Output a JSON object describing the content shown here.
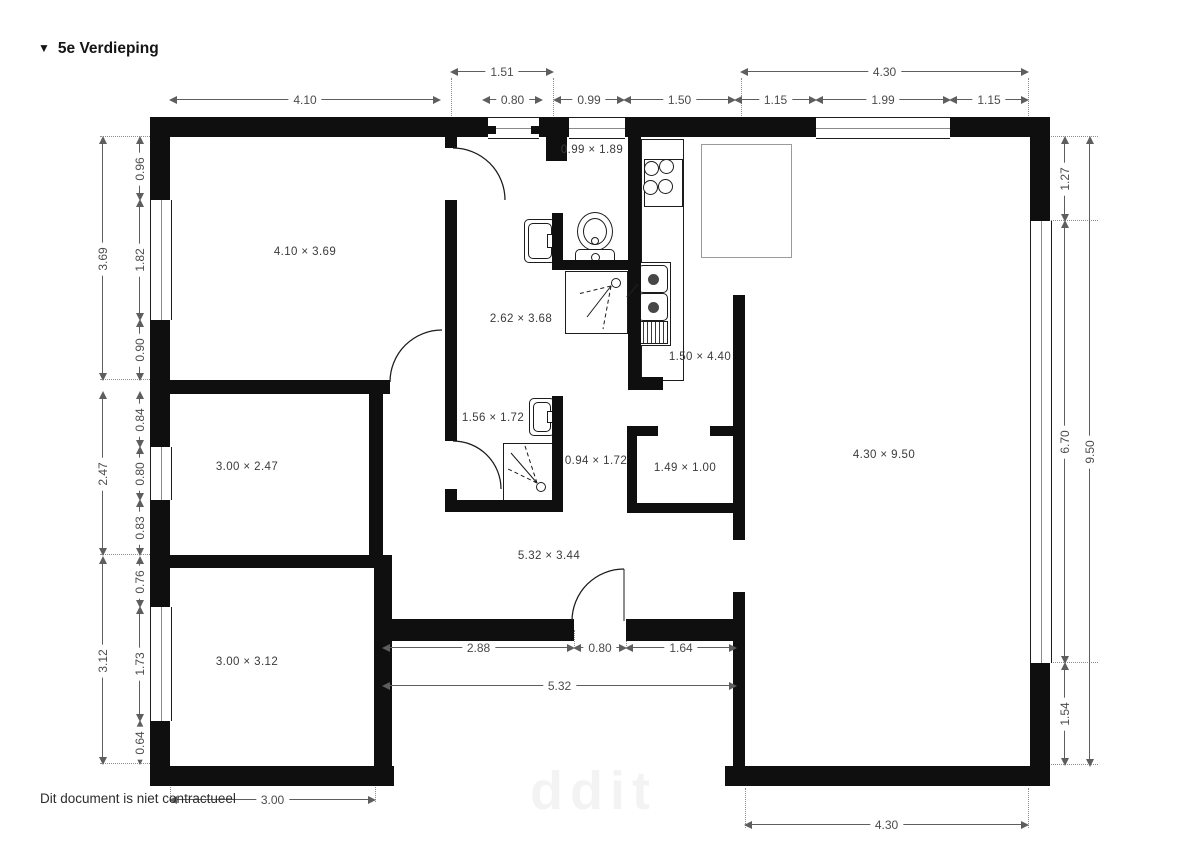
{
  "title": {
    "marker": "▼",
    "text": "5e Verdieping"
  },
  "footer": {
    "text": "Dit document is niet contractueel"
  },
  "watermark": {
    "text": "ddit"
  },
  "colors": {
    "wall": "#0f0f0f",
    "dimension_line": "#5e5e5e",
    "label": "#3b3b3b"
  },
  "plan": {
    "rooms": [
      {
        "x": 305,
        "y": 252,
        "t": "4.10 × 3.69"
      },
      {
        "x": 521,
        "y": 319,
        "t": "2.62 × 3.68"
      },
      {
        "x": 592,
        "y": 150,
        "t": "0.99 × 1.89"
      },
      {
        "x": 700,
        "y": 357,
        "t": "1.50 × 4.40"
      },
      {
        "x": 247,
        "y": 467,
        "t": "3.00 × 2.47"
      },
      {
        "x": 493,
        "y": 418,
        "t": "1.56 × 1.72"
      },
      {
        "x": 596,
        "y": 461,
        "t": "0.94 × 1.72"
      },
      {
        "x": 685,
        "y": 468,
        "t": "1.49 × 1.00"
      },
      {
        "x": 884,
        "y": 455,
        "t": "4.30 × 9.50"
      },
      {
        "x": 247,
        "y": 662,
        "t": "3.00 × 3.12"
      },
      {
        "x": 549,
        "y": 556,
        "t": "5.32 × 3.44"
      }
    ],
    "dims_h": [
      {
        "x": 451,
        "y": 66,
        "w": 102,
        "t": "1.51"
      },
      {
        "x": 741,
        "y": 66,
        "w": 287,
        "t": "4.30"
      },
      {
        "x": 170,
        "y": 94,
        "w": 270,
        "t": "4.10"
      },
      {
        "x": 483,
        "y": 94,
        "w": 59,
        "t": "0.80"
      },
      {
        "x": 554,
        "y": 94,
        "w": 70,
        "t": "0.99"
      },
      {
        "x": 624,
        "y": 94,
        "w": 111,
        "t": "1.50"
      },
      {
        "x": 735,
        "y": 94,
        "w": 81,
        "t": "1.15"
      },
      {
        "x": 816,
        "y": 94,
        "w": 134,
        "t": "1.99"
      },
      {
        "x": 950,
        "y": 94,
        "w": 78,
        "t": "1.15"
      },
      {
        "x": 383,
        "y": 642,
        "w": 191,
        "t": "2.88"
      },
      {
        "x": 574,
        "y": 642,
        "w": 52,
        "t": "0.80"
      },
      {
        "x": 626,
        "y": 642,
        "w": 110,
        "t": "1.64"
      },
      {
        "x": 383,
        "y": 680,
        "w": 353,
        "t": "5.32"
      },
      {
        "x": 170,
        "y": 794,
        "w": 205,
        "t": "3.00"
      },
      {
        "x": 745,
        "y": 819,
        "w": 283,
        "t": "4.30"
      }
    ],
    "dims_v": [
      {
        "x": 97,
        "y": 137,
        "h": 243,
        "t": "3.69"
      },
      {
        "x": 134,
        "y": 137,
        "h": 63,
        "t": "0.96"
      },
      {
        "x": 134,
        "y": 200,
        "h": 120,
        "t": "1.82"
      },
      {
        "x": 134,
        "y": 320,
        "h": 60,
        "t": "0.90"
      },
      {
        "x": 97,
        "y": 392,
        "h": 163,
        "t": "2.47"
      },
      {
        "x": 134,
        "y": 392,
        "h": 55,
        "t": "0.84"
      },
      {
        "x": 134,
        "y": 447,
        "h": 53,
        "t": "0.80"
      },
      {
        "x": 134,
        "y": 500,
        "h": 55,
        "t": "0.83"
      },
      {
        "x": 97,
        "y": 557,
        "h": 207,
        "t": "3.12"
      },
      {
        "x": 134,
        "y": 557,
        "h": 50,
        "t": "0.76"
      },
      {
        "x": 134,
        "y": 607,
        "h": 114,
        "t": "1.73"
      },
      {
        "x": 134,
        "y": 721,
        "h": 43,
        "t": "0.64"
      },
      {
        "x": 1059,
        "y": 137,
        "h": 84,
        "t": "1.27"
      },
      {
        "x": 1059,
        "y": 221,
        "h": 442,
        "t": "6.70"
      },
      {
        "x": 1059,
        "y": 663,
        "h": 102,
        "t": "1.54"
      },
      {
        "x": 1084,
        "y": 137,
        "h": 629,
        "t": "9.50"
      }
    ],
    "walls": [
      [
        150,
        117,
        338,
        20
      ],
      [
        539,
        117,
        30,
        20
      ],
      [
        625,
        117,
        191,
        20
      ],
      [
        950,
        117,
        100,
        20
      ],
      [
        150,
        117,
        20,
        83
      ],
      [
        150,
        320,
        20,
        127
      ],
      [
        150,
        500,
        20,
        107
      ],
      [
        150,
        721,
        20,
        65
      ],
      [
        1030,
        117,
        20,
        104
      ],
      [
        1030,
        663,
        20,
        123
      ],
      [
        150,
        766,
        244,
        20
      ],
      [
        725,
        766,
        325,
        20
      ],
      [
        170,
        380,
        220,
        14
      ],
      [
        445,
        134,
        12,
        14
      ],
      [
        445,
        200,
        12,
        194
      ],
      [
        445,
        394,
        12,
        47
      ],
      [
        445,
        489,
        12,
        23
      ],
      [
        445,
        500,
        118,
        12
      ],
      [
        552,
        396,
        11,
        104
      ],
      [
        546,
        134,
        21,
        27
      ],
      [
        552,
        213,
        11,
        51
      ],
      [
        552,
        260,
        76,
        10
      ],
      [
        628,
        137,
        13,
        253
      ],
      [
        628,
        377,
        35,
        13
      ],
      [
        627,
        426,
        31,
        10
      ],
      [
        710,
        426,
        25,
        10
      ],
      [
        627,
        426,
        10,
        87
      ],
      [
        627,
        503,
        108,
        10
      ],
      [
        369,
        394,
        14,
        161
      ],
      [
        170,
        555,
        204,
        13
      ],
      [
        374,
        555,
        18,
        231
      ],
      [
        374,
        619,
        200,
        22
      ],
      [
        626,
        619,
        119,
        22
      ],
      [
        733,
        295,
        12,
        245
      ],
      [
        733,
        592,
        12,
        174
      ]
    ],
    "windows_h": [
      [
        488,
        117,
        51,
        20
      ],
      [
        569,
        117,
        56,
        20
      ],
      [
        816,
        117,
        134,
        20
      ]
    ],
    "windows_v": [
      [
        150,
        200,
        20,
        120
      ],
      [
        150,
        447,
        20,
        53
      ],
      [
        150,
        607,
        20,
        114
      ],
      [
        1030,
        221,
        20,
        442
      ]
    ],
    "jambs": [
      [
        488,
        126,
        8,
        8
      ],
      [
        531,
        126,
        8,
        8
      ]
    ],
    "ext_v": [
      [
        451,
        78,
        56
      ],
      [
        553,
        78,
        42
      ],
      [
        741,
        78,
        40
      ],
      [
        1028,
        78,
        40
      ],
      [
        170,
        770,
        32
      ],
      [
        375,
        642,
        160
      ],
      [
        745,
        788,
        40
      ],
      [
        1028,
        788,
        40
      ],
      [
        574,
        630,
        16
      ],
      [
        626,
        630,
        16
      ]
    ],
    "ext_h": [
      [
        100,
        136,
        52
      ],
      [
        100,
        379,
        52
      ],
      [
        100,
        554,
        52
      ],
      [
        100,
        763,
        52
      ],
      [
        1048,
        136,
        50
      ],
      [
        1048,
        220,
        50
      ],
      [
        1048,
        662,
        50
      ],
      [
        1048,
        764,
        50
      ]
    ],
    "fixtures": [
      {
        "k": "r",
        "n": "kitchen-counter",
        "x": 641,
        "y": 139,
        "w": 41,
        "h": 240
      },
      {
        "k": "r",
        "n": "stove-icon",
        "x": 644,
        "y": 159,
        "w": 37,
        "h": 46
      },
      {
        "k": "c",
        "n": "stove-burner-icon",
        "x": 650,
        "y": 167,
        "d": 13
      },
      {
        "k": "c",
        "n": "stove-burner-icon",
        "x": 665,
        "y": 165,
        "d": 13
      },
      {
        "k": "c",
        "n": "stove-burner-icon",
        "x": 649,
        "y": 186,
        "d": 13
      },
      {
        "k": "c",
        "n": "stove-burner-icon",
        "x": 664,
        "y": 185,
        "d": 13
      },
      {
        "k": "r",
        "n": "kitchen-sink-icon",
        "x": 635,
        "y": 262,
        "w": 34,
        "h": 82
      },
      {
        "k": "r",
        "n": "sink-basin",
        "x": 638,
        "y": 265,
        "w": 28,
        "h": 26,
        "rd": 1
      },
      {
        "k": "r",
        "n": "sink-basin",
        "x": 638,
        "y": 293,
        "w": 28,
        "h": 26,
        "rd": 1
      },
      {
        "k": "c",
        "n": "sink-drain",
        "x": 652,
        "y": 278,
        "d": 9,
        "f": 1
      },
      {
        "k": "c",
        "n": "sink-drain",
        "x": 652,
        "y": 306,
        "d": 9,
        "f": 1
      },
      {
        "k": "h",
        "n": "sink-drainer",
        "x": 638,
        "y": 321,
        "w": 28,
        "h": 21
      },
      {
        "k": "r",
        "n": "island-counter",
        "x": 701,
        "y": 144,
        "w": 89,
        "h": 112,
        "gy": 1
      },
      {
        "k": "r",
        "n": "toilet-icon",
        "x": 577,
        "y": 212,
        "w": 34,
        "h": 37,
        "ell": 1
      },
      {
        "k": "r",
        "n": "toilet-bowl-inner",
        "x": 583,
        "y": 218,
        "w": 22,
        "h": 25,
        "ell": 1
      },
      {
        "k": "c",
        "n": "toilet-flush-dot",
        "x": 594,
        "y": 240,
        "d": 6
      },
      {
        "k": "r",
        "n": "toilet-cistern",
        "x": 575,
        "y": 249,
        "w": 38,
        "h": 15,
        "rd": 1
      },
      {
        "k": "c",
        "n": "toilet-flush-dot",
        "x": 594,
        "y": 256,
        "d": 7
      },
      {
        "k": "r",
        "n": "washbasin-icon",
        "x": 524,
        "y": 219,
        "w": 30,
        "h": 42,
        "rd": 1
      },
      {
        "k": "r",
        "n": "washbasin-inner",
        "x": 528,
        "y": 223,
        "w": 22,
        "h": 34,
        "rd": 1
      },
      {
        "k": "r",
        "n": "washbasin-tap",
        "x": 547,
        "y": 234,
        "w": 8,
        "h": 12
      },
      {
        "k": "r",
        "n": "shower-tray-icon",
        "x": 565,
        "y": 271,
        "w": 61,
        "h": 61
      },
      {
        "k": "c",
        "n": "shower-drain",
        "x": 615,
        "y": 282,
        "d": 8
      },
      {
        "k": "r",
        "n": "washbasin-icon",
        "x": 529,
        "y": 398,
        "w": 24,
        "h": 36,
        "rd": 1
      },
      {
        "k": "r",
        "n": "washbasin-inner",
        "x": 533,
        "y": 402,
        "w": 16,
        "h": 28,
        "rd": 1
      },
      {
        "k": "r",
        "n": "washbasin-tap",
        "x": 547,
        "y": 411,
        "w": 7,
        "h": 10
      },
      {
        "k": "r",
        "n": "shower-tray-icon",
        "x": 503,
        "y": 443,
        "w": 51,
        "h": 57
      },
      {
        "k": "c",
        "n": "shower-drain",
        "x": 540,
        "y": 486,
        "d": 8
      }
    ],
    "arcs": [
      {
        "n": "door-swing-arc",
        "d": "M 453 148 A 52 52 0 0 1 505 200"
      },
      {
        "n": "door-swing-arc",
        "d": "M 442 330 A 52 52 0 0 0 390 382"
      },
      {
        "n": "door-swing-arc",
        "d": "M 453 441 A 48 48 0 0 1 501 489"
      },
      {
        "n": "door-swing-arc",
        "d": "M 572 621 A 52 52 0 0 1 624 569"
      },
      {
        "n": "door-leaf-line",
        "d": "M 624 569 L 624 621",
        "w": 1
      },
      {
        "n": "shower-spray-line",
        "d": "M 611 286 L 578 294",
        "dash": 1,
        "w": 1
      },
      {
        "n": "shower-spray-line",
        "d": "M 611 286 L 587 317",
        "w": 1
      },
      {
        "n": "shower-spray-line",
        "d": "M 611 286 L 603 329",
        "dash": 1,
        "w": 1
      },
      {
        "n": "shower-spray-line",
        "d": "M 537 483 L 511 453",
        "w": 1
      },
      {
        "n": "shower-spray-line",
        "d": "M 537 483 L 525 446",
        "dash": 1,
        "w": 1
      },
      {
        "n": "shower-spray-line",
        "d": "M 537 483 L 506 468",
        "dash": 1,
        "w": 1
      },
      {
        "n": "tap-mark",
        "d": "M 627 297 L 638 284",
        "w": 1.6
      }
    ]
  }
}
